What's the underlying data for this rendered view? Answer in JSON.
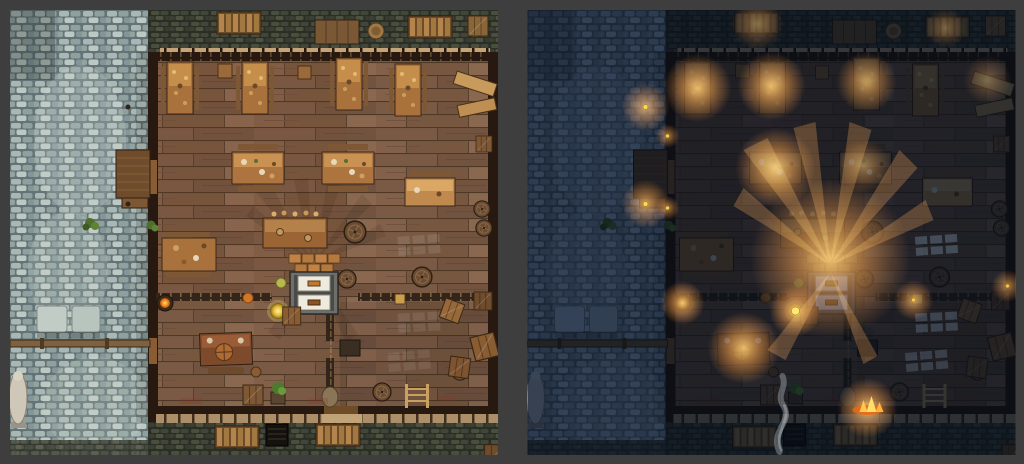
{
  "frame": {
    "background_color": "#3e3e3e",
    "border_px": 10,
    "gap_px": 29
  },
  "panels": [
    {
      "variant": "day",
      "label": "tavern-battlemap-day"
    },
    {
      "variant": "night",
      "label": "tavern-battlemap-night"
    }
  ],
  "palette": {
    "frame_background": "#3e3e3e",
    "cobble_base": "#6a7a7a",
    "cobble_light": "#c2cdc8",
    "stone_yard": "#2e3129",
    "wood_floor": "#7d5d47",
    "wood_plank_gap": "#4e3826",
    "wall_dark": "#27190f",
    "awning_beam": "#c4a378",
    "table_wood": "#ae7440",
    "table_top_lit": "#d09a56",
    "oven_white": "#efeade",
    "lamp_yellow": "#ffe873",
    "night": {
      "multiply_tint": "#5a6884",
      "depth_tint": "#0e1a33",
      "glow_core": "#ffc65e",
      "glow_mid": "#ff9e38",
      "lantern_dot": "#ffd84e",
      "moonlight": "#b8d4f0"
    }
  },
  "map_features": [
    "cobblestone-street",
    "stone-yard-top",
    "stone-yard-bottom",
    "wooden-tavern-floor",
    "bar-counter",
    "twin-oven-hearth",
    "crate-stack",
    "dining-tables",
    "benches",
    "barrels",
    "crates",
    "pallets",
    "ladder",
    "street-statue",
    "cellar-doors",
    "street-railing",
    "market-awning",
    "brazier",
    "glowing-lamp",
    "plant-pot",
    "sack",
    "window-light-patches"
  ],
  "night_lights": [
    {
      "name": "street-lantern-upper",
      "x": 118,
      "y": 97
    },
    {
      "name": "street-lantern-lower",
      "x": 118,
      "y": 194
    },
    {
      "name": "wall-lantern-upper",
      "x": 140,
      "y": 126
    },
    {
      "name": "wall-lantern-lower",
      "x": 140,
      "y": 198
    },
    {
      "name": "top-table-1",
      "x": 170,
      "y": 78
    },
    {
      "name": "top-table-2",
      "x": 244,
      "y": 76
    },
    {
      "name": "middle-table",
      "x": 248,
      "y": 158
    },
    {
      "name": "bar-chandelier",
      "x": 303,
      "y": 248
    },
    {
      "name": "standing-lamp",
      "x": 268,
      "y": 301
    },
    {
      "name": "brazier",
      "x": 155,
      "y": 293
    },
    {
      "name": "desk-candle",
      "x": 216,
      "y": 338
    },
    {
      "name": "wall-lantern-right",
      "x": 386,
      "y": 290
    },
    {
      "name": "entrance-fire",
      "x": 340,
      "y": 398
    }
  ]
}
